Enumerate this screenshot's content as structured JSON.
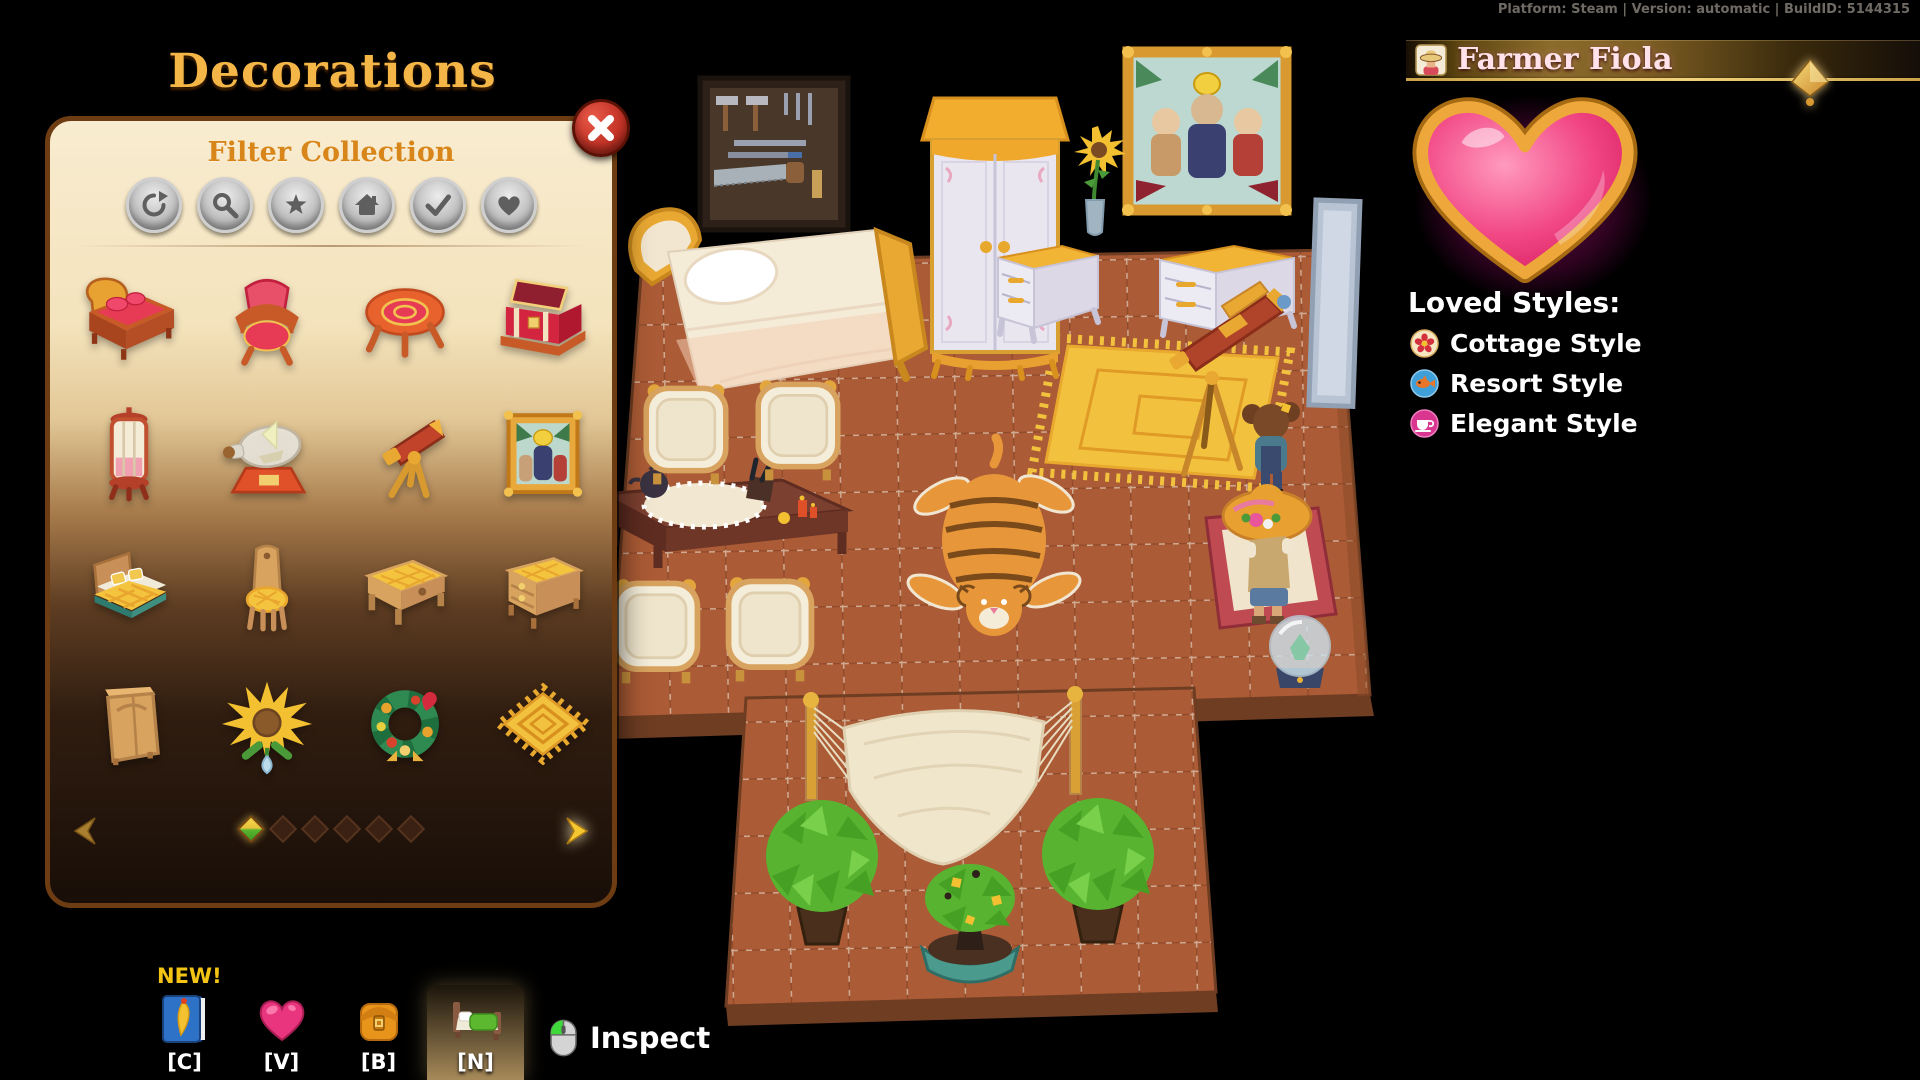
{
  "debug_bar": {
    "text": "Platform: Steam | Version: automatic | BuildID: 5144315"
  },
  "decorations_panel": {
    "title": "Decorations",
    "filter_section": {
      "title": "Filter Collection"
    },
    "filters": [
      {
        "name": "reset-filter",
        "icon": "refresh-icon"
      },
      {
        "name": "search-filter",
        "icon": "search-icon"
      },
      {
        "name": "favorites-filter",
        "icon": "star-icon"
      },
      {
        "name": "furniture-filter",
        "icon": "house-icon"
      },
      {
        "name": "owned-filter",
        "icon": "check-icon"
      },
      {
        "name": "loved-filter",
        "icon": "heart-icon"
      }
    ],
    "items": [
      {
        "name": "red-bed"
      },
      {
        "name": "red-armchair"
      },
      {
        "name": "red-round-table"
      },
      {
        "name": "red-chest"
      },
      {
        "name": "red-display-lamp"
      },
      {
        "name": "ship-in-a-bottle"
      },
      {
        "name": "telescope"
      },
      {
        "name": "framed-painting"
      },
      {
        "name": "yellow-bed"
      },
      {
        "name": "yellow-chair"
      },
      {
        "name": "yellow-table"
      },
      {
        "name": "yellow-dresser"
      },
      {
        "name": "wooden-wardrobe"
      },
      {
        "name": "sunflower"
      },
      {
        "name": "flower-wreath"
      },
      {
        "name": "sun-mat"
      }
    ],
    "pagination": {
      "total_pages": 6,
      "current_page": 1
    }
  },
  "hotbar": {
    "new_badge": "NEW!",
    "buttons": [
      {
        "key": "[C]",
        "icon": "journal-icon",
        "selected": false
      },
      {
        "key": "[V]",
        "icon": "heart-icon",
        "selected": false
      },
      {
        "key": "[B]",
        "icon": "backpack-icon",
        "selected": false
      },
      {
        "key": "[N]",
        "icon": "bed-icon",
        "selected": true
      }
    ],
    "inspect_label": "Inspect"
  },
  "npc_panel": {
    "name": "Farmer Fiola",
    "loved_styles_title": "Loved Styles:",
    "styles": [
      {
        "label": "Cottage Style",
        "icon": "flower-icon",
        "icon_bg": "#f6e7c2"
      },
      {
        "label": "Resort Style",
        "icon": "fish-icon",
        "icon_bg": "#3f9fd8"
      },
      {
        "label": "Elegant Style",
        "icon": "teacup-icon",
        "icon_bg": "#d8368f"
      }
    ]
  },
  "colors": {
    "title_gold": "#f4b646",
    "panel_cream": "#f4e3bc",
    "heart_pink": "#f24a86",
    "heart_border_gold": "#eaa42f",
    "floor_terracotta": "#ab5b35",
    "accent_orange": "#d8861a"
  }
}
